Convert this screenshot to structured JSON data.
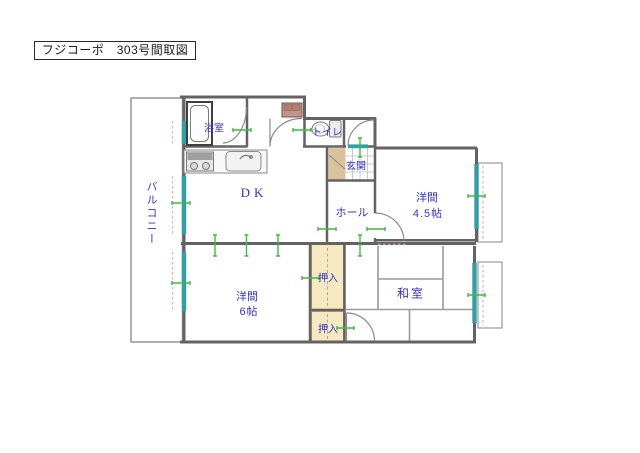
{
  "title": "フジコーポ　303号間取図",
  "plan": {
    "balcony": "バルコニー",
    "bathroom": "浴室",
    "toilet": "トイレ",
    "entrance": "玄関",
    "dining_kitchen": "DK",
    "hall": "ホール",
    "western_room_45": {
      "name": "洋間",
      "size": "4.5帖"
    },
    "western_room_6": {
      "name": "洋間",
      "size": "6帖"
    },
    "japanese_room": "和室",
    "closet_upper": "押入",
    "closet_lower": "押入"
  },
  "colors": {
    "label": "#3333cc",
    "wall": "#636363",
    "window": "#2f9fa8",
    "tick": "#3fbb3f",
    "dashed": "#e2a9cd",
    "genkan_floor": "#d9c29c",
    "closet_fill": "#f6e8c0"
  }
}
